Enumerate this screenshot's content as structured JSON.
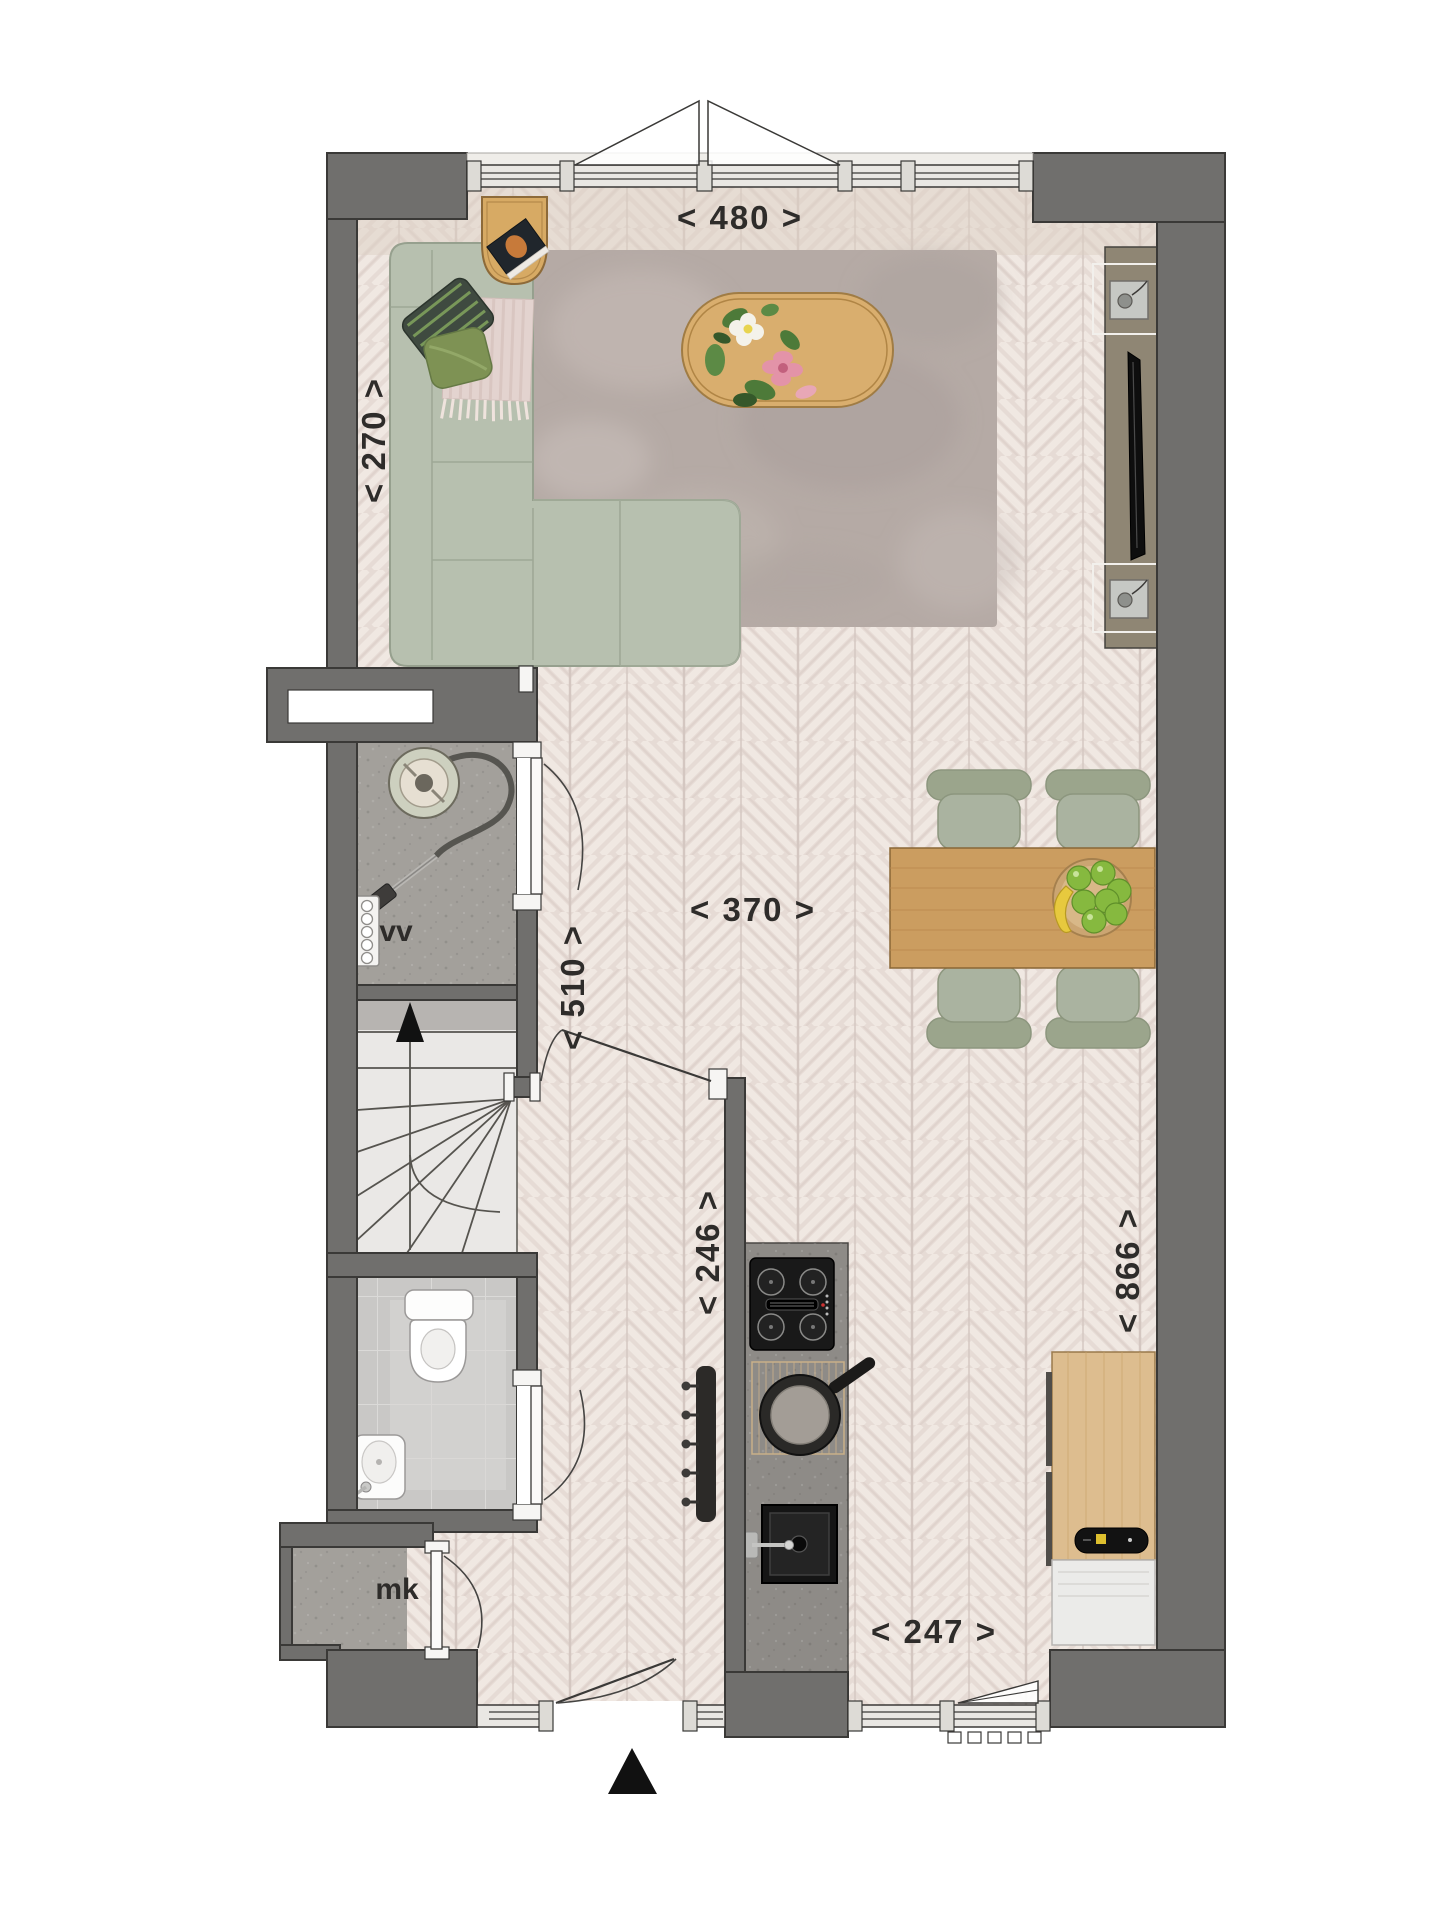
{
  "plan": {
    "dimensions": {
      "top_width": "< 480 >",
      "living_depth": "< 270 >",
      "hall_depth": "< 510 >",
      "living_width": "< 370 >",
      "kitchen_width": "< 246 >",
      "plan_depth": "< 866 >",
      "kitchen_front": "< 247 >"
    },
    "rooms": {
      "storage_label": "vv",
      "meter_cupboard_label": "mk"
    },
    "colors": {
      "wall": "#706f6d",
      "floor_base": "#e6dbd5",
      "rug": "#b5aaa5",
      "sofa": "#b7c0af",
      "wood_table": "#cb9d60",
      "kitchen_counter": "#8e8b87",
      "media_unit": "#8f8674",
      "label_text": "#2e2c2a"
    },
    "icons": {
      "north": "north-arrow"
    }
  }
}
